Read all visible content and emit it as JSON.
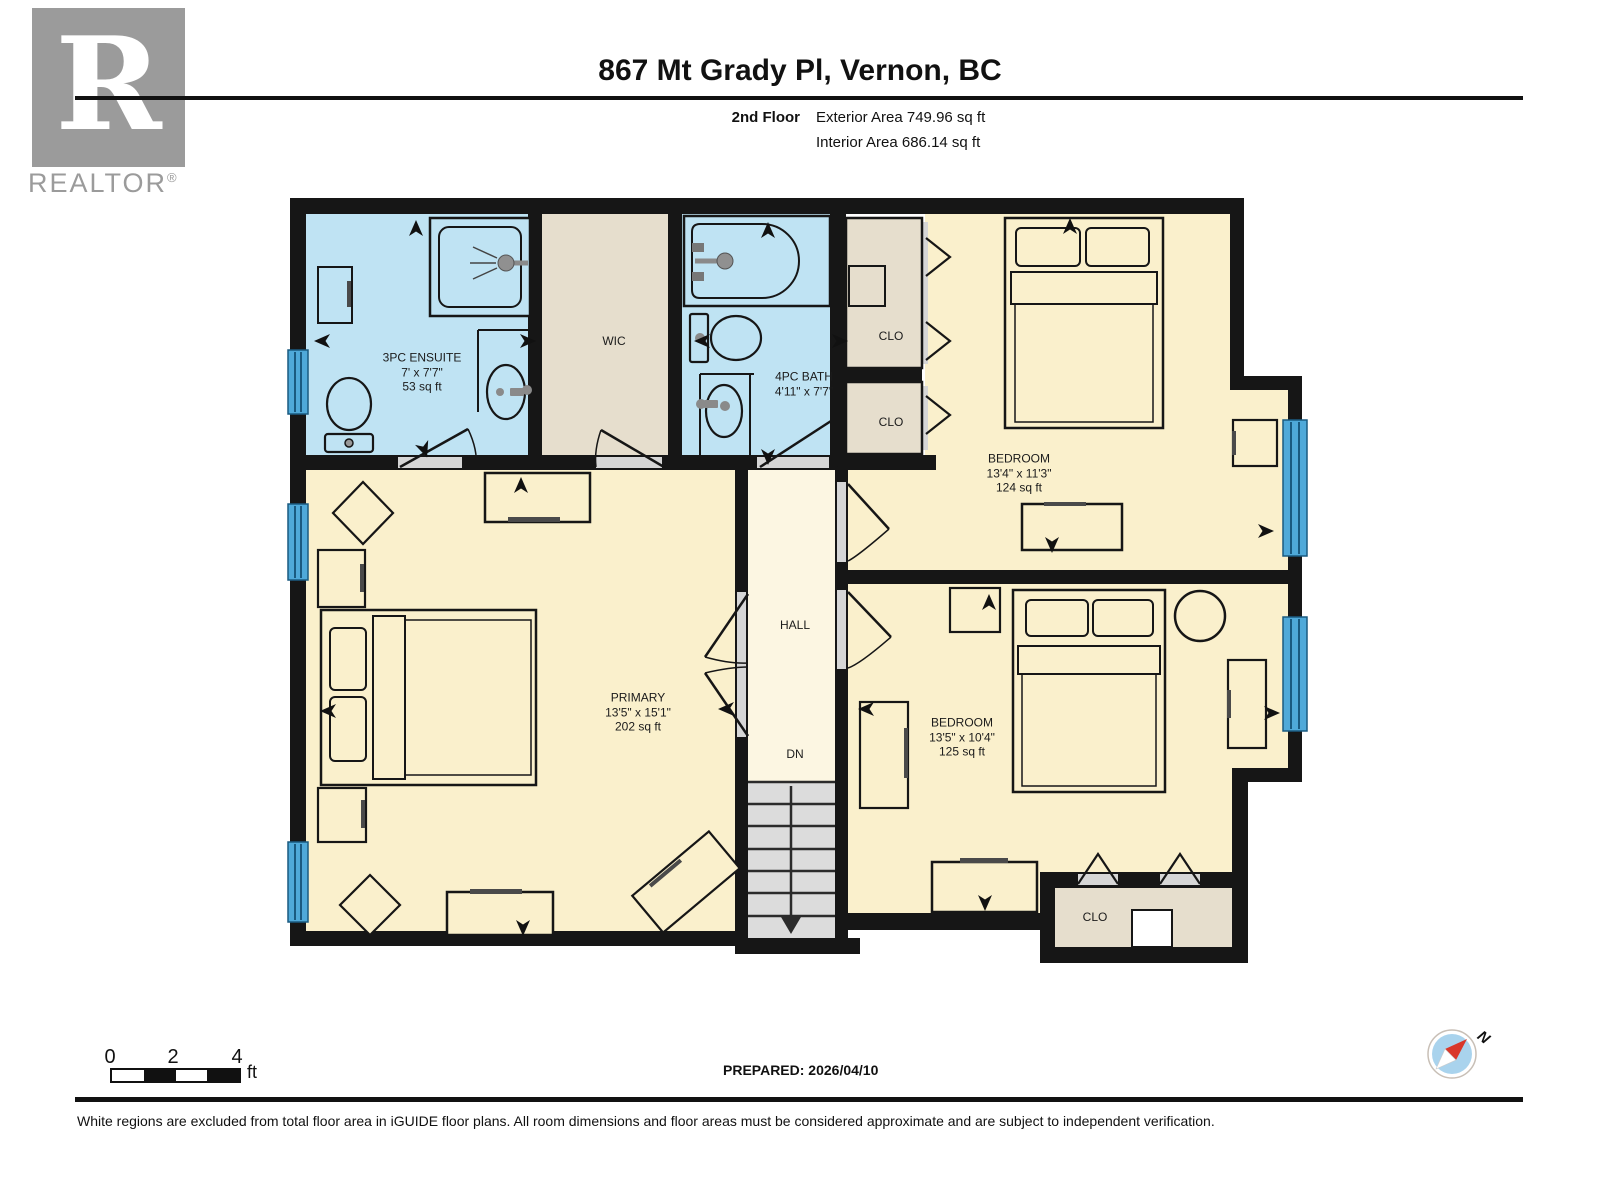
{
  "header": {
    "logo": {
      "letter": "R",
      "brand": "REALTOR",
      "registered": "®"
    },
    "title": "867 Mt Grady Pl, Vernon, BC",
    "floor_label": "2nd Floor",
    "exterior_area": "Exterior Area 749.96 sq ft",
    "interior_area": "Interior Area 686.14 sq ft"
  },
  "plan": {
    "rooms": {
      "ensuite": {
        "name": "3PC ENSUITE",
        "dims": "7' x 7'7\"",
        "area": "53 sq ft"
      },
      "wic": {
        "name": "WIC"
      },
      "bath": {
        "name": "4PC BATH",
        "dims": "4'11\" x 7'7\""
      },
      "clo_upper": {
        "name": "CLO"
      },
      "clo_lower": {
        "name": "CLO"
      },
      "bedroom_ne": {
        "name": "BEDROOM",
        "dims": "13'4\" x 11'3\"",
        "area": "124 sq ft"
      },
      "hall": {
        "name": "HALL",
        "down_label": "DN"
      },
      "primary": {
        "name": "PRIMARY",
        "dims": "13'5\" x 15'1\"",
        "area": "202 sq ft"
      },
      "bedroom_se": {
        "name": "BEDROOM",
        "dims": "13'5\" x 10'4\"",
        "area": "125 sq ft"
      },
      "clo_bottom": {
        "name": "CLO"
      }
    }
  },
  "footer": {
    "scale": {
      "ticks": [
        "0",
        "2",
        "4"
      ],
      "unit": "ft"
    },
    "prepared": "PREPARED: 2026/04/10",
    "compass_north": "N",
    "disclaimer": "White regions are excluded from total floor area in iGUIDE floor plans. All room dimensions and floor areas must be considered approximate and are subject to independent verification."
  },
  "colors": {
    "wall": "#161616",
    "room_cream": "#FAF0CC",
    "hall_cream": "#FCF6E2",
    "bath_blue": "#BFE3F3",
    "closet_tan": "#E6DECD",
    "stairs_gray": "#DCDCDC",
    "window_blue": "#4FA9D9",
    "door_sill_gray": "#D6D6D6",
    "logo_gray": "#9B9B9B",
    "compass_blue": "#A9D3ED",
    "compass_red": "#D9372A"
  }
}
